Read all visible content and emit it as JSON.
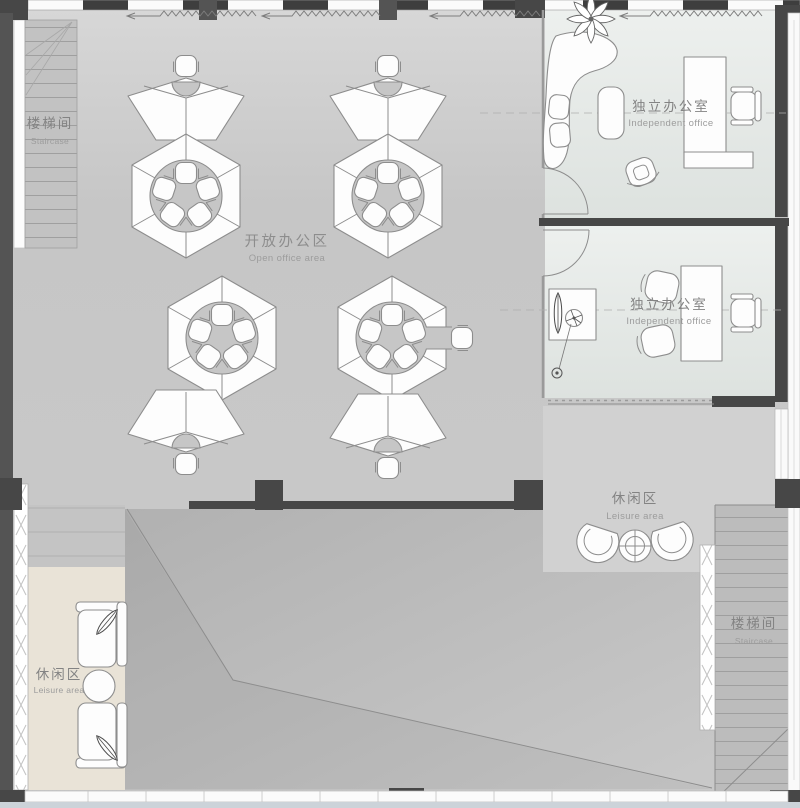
{
  "labels": {
    "staircase_top_left": {
      "zh": "楼梯间",
      "en": "Staircase"
    },
    "open_office": {
      "zh": "开放办公区",
      "en": "Open office area"
    },
    "independent_office_top": {
      "zh": "独立办公室",
      "en": "Independent office"
    },
    "independent_office_bottom": {
      "zh": "独立办公室",
      "en": "Independent office"
    },
    "leisure_area_left": {
      "zh": "休闲区",
      "en": "Leisure area"
    },
    "leisure_area_right": {
      "zh": "休闲区",
      "en": "Leisure area"
    },
    "staircase_bottom_right": {
      "zh": "楼梯间",
      "en": "Staircase"
    }
  },
  "colors": {
    "floor_main": "#c7c7c7",
    "floor_office": "#e1e5e2",
    "floor_leisure_beige": "#e9e3d7",
    "floor_leisure_gray": "#d1d1d1",
    "floor_void": "#bcbcbc",
    "stair_tread": "#c2c2c2",
    "wall_dark": "#474747",
    "furniture_fill": "#fdfdfd",
    "furniture_stroke": "#8d8d8d",
    "label_zh": "#838383",
    "label_en": "#9c9c9c"
  }
}
